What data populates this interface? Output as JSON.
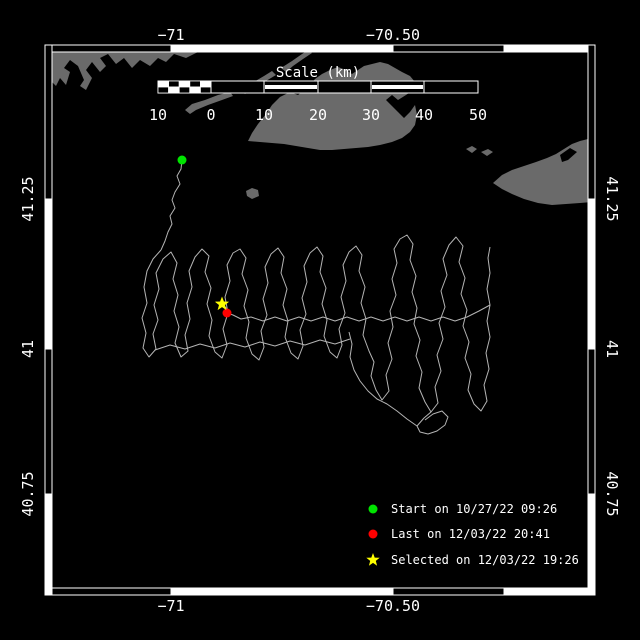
{
  "title": "Glider track map",
  "colors": {
    "background": "#000000",
    "land": "#6a6a6a",
    "track": "#b4b4b4",
    "frame_white": "#ffffff",
    "frame_black": "#000000",
    "text": "#ffffff",
    "start_marker": "#00e400",
    "last_marker": "#ff0000",
    "selected_marker": "#ffff00"
  },
  "frame": {
    "outer": {
      "x": 45,
      "y": 45,
      "w": 550,
      "h": 550
    },
    "band": 7,
    "horizontal_segments": [
      {
        "from": 45,
        "to": 171,
        "fill": "black"
      },
      {
        "from": 171,
        "to": 393,
        "fill": "white"
      },
      {
        "from": 393,
        "to": 504,
        "fill": "black"
      },
      {
        "from": 504,
        "to": 595,
        "fill": "white"
      }
    ],
    "vertical_segments": [
      {
        "from": 45,
        "to": 199,
        "fill": "black"
      },
      {
        "from": 199,
        "to": 349,
        "fill": "white"
      },
      {
        "from": 349,
        "to": 494,
        "fill": "black"
      },
      {
        "from": 494,
        "to": 595,
        "fill": "white"
      }
    ]
  },
  "axis": {
    "top": {
      "baseline_y": 40,
      "ticks": [
        {
          "text": "−71",
          "x": 171
        },
        {
          "text": "−70.50",
          "x": 393
        }
      ]
    },
    "bottom": {
      "baseline_y": 611,
      "ticks": [
        {
          "text": "−71",
          "x": 171
        },
        {
          "text": "−70.50",
          "x": 393
        }
      ]
    },
    "left": {
      "line_x": 33,
      "ticks": [
        {
          "text": "41.25",
          "y": 199
        },
        {
          "text": "41",
          "y": 349
        },
        {
          "text": "40.75",
          "y": 494
        }
      ]
    },
    "right": {
      "line_x": 607,
      "ticks": [
        {
          "text": "41.25",
          "y": 199
        },
        {
          "text": "41",
          "y": 349
        },
        {
          "text": "40.75",
          "y": 494
        }
      ]
    }
  },
  "scalebar": {
    "title": "Scale (km)",
    "title_x": 318,
    "title_y": 77,
    "x": 158,
    "y": 81,
    "width": 320,
    "height": 12,
    "checker": {
      "from": 158,
      "to": 211,
      "cells": 5
    },
    "segments": [
      {
        "from": 211,
        "to": 264,
        "stripe": false
      },
      {
        "from": 264,
        "to": 318,
        "stripe": true
      },
      {
        "from": 318,
        "to": 371,
        "stripe": false
      },
      {
        "from": 371,
        "to": 424,
        "stripe": true
      },
      {
        "from": 424,
        "to": 478,
        "stripe": false
      }
    ],
    "labels": [
      {
        "text": "10",
        "x": 158
      },
      {
        "text": "0",
        "x": 211
      },
      {
        "text": "10",
        "x": 264
      },
      {
        "text": "20",
        "x": 318
      },
      {
        "text": "30",
        "x": 371
      },
      {
        "text": "40",
        "x": 424
      },
      {
        "text": "50",
        "x": 478
      }
    ],
    "label_baseline_y": 120
  },
  "markers": {
    "start": {
      "x": 182,
      "y": 160,
      "r": 4.5
    },
    "last": {
      "x": 227,
      "y": 313,
      "r": 4.5
    },
    "selected": {
      "x": 222,
      "y": 304,
      "r": 7.5
    }
  },
  "legend": {
    "marker_x": 373,
    "text_x": 391,
    "rows_y": [
      509,
      534,
      560
    ],
    "items": [
      {
        "marker": "circle",
        "color_key": "start_marker",
        "label": "Start on 10/27/22 09:26"
      },
      {
        "marker": "circle",
        "color_key": "last_marker",
        "label": "Last on 12/03/22 20:41"
      },
      {
        "marker": "star",
        "color_key": "selected_marker",
        "label": "Selected on 12/03/22 19:26"
      }
    ]
  },
  "land": {
    "polygons": [
      {
        "name": "mainland-coast",
        "fill": "land",
        "points": "47,49 205,49 196,53 186,58 174,54 166,62 158,58 150,66 140,60 132,68 124,58 116,64 108,54 100,58 106,66 100,72 92,62 86,70 92,78 86,90 80,86 84,80 78,66 70,60 64,68 70,72 66,85 60,78 56,86 52,82 47,88"
      },
      {
        "name": "elizabeth-island-a",
        "fill": "land",
        "points": "185,110 192,104 205,100 218,95 230,92 233,96 222,100 208,105 196,110 190,114"
      },
      {
        "name": "elizabeth-island-b",
        "fill": "land",
        "points": "240,90 252,83 264,76 272,71 276,75 266,81 254,88 245,94"
      },
      {
        "name": "elizabeth-island-c",
        "fill": "land",
        "points": "281,68 292,61 302,54 308,50 312,53 303,59 293,66 286,72"
      },
      {
        "name": "marthas-vineyard",
        "fill": "land",
        "points": "248,141 252,133 258,124 266,114 272,105 280,97 290,92 298,95 304,90 310,85 315,79 322,74 330,70 338,67 346,70 352,74 358,70 364,66 372,64 380,62 388,64 395,68 402,72 410,76 415,82 413,90 406,95 398,100 392,95 386,100 392,106 398,112 404,118 410,112 415,105 417,115 415,125 410,132 402,138 392,142 380,145 368,147 356,148 344,149 332,150 320,150 308,148 296,146 284,144 272,143 260,142"
      },
      {
        "name": "no-mans-land",
        "fill": "land",
        "points": "246,191 252,188 258,190 259,196 252,199 247,196"
      },
      {
        "name": "muskeget",
        "fill": "land",
        "points": "466,149 472,146 477,149 472,153"
      },
      {
        "name": "tuckernuck",
        "fill": "land",
        "points": "481,152 488,149 493,152 487,156"
      },
      {
        "name": "nantucket",
        "fill": "land",
        "points": "493,183 502,175 512,170 524,166 536,162 547,158 556,154 564,149 572,144 580,141 588,139 592,139 592,202 580,203 566,204 552,205 538,203 524,199 512,194 502,189"
      },
      {
        "name": "nantucket-harbor",
        "fill": "background",
        "points": "560,155 570,148 577,152 568,160 562,162"
      }
    ]
  },
  "track": {
    "polylines": [
      "182,160 181,169 177,176 180,184 175,192 172,200 175,208 170,216 172,224 168,232 165,241 161,250",
      "161,250 153,259 147,271 144,287 147,303 142,318 146,333 143,348 149,357 156,349 153,334 158,320 154,305 159,289 156,273 163,259 171,252 177,263 173,279 178,295 174,311 179,327 175,343 181,357 188,351 185,335 190,319 187,303 192,287 189,271 195,257 202,249 209,256 205,272 211,288 207,304 212,320 209,336 215,352 222,358 227,345 223,329 228,313 225,297 230,281 227,265 233,253 240,249 246,258 242,274 248,290 244,306 249,322 246,338 252,354 259,360 264,347 261,331 267,315 263,299 268,283 265,267 271,254 278,248 284,257 281,273 287,289 283,305 288,321 285,337 291,353 298,359 303,346 300,330 306,314 302,298 307,282 304,266 310,253 317,247 323,256 320,272 326,288 322,304 327,320 324,336 330,352 337,358 342,345 339,329 345,313 341,297 346,281 343,265 349,252 356,246 362,255 359,271 365,287 361,303 366,319 363,335 369,351 374,362 371,376 376,390 382,400 389,391 386,375 392,359 388,343 393,327 390,311 396,295 392,279 397,263 394,249 400,239 407,235 413,244 410,260 416,276 412,292 417,308 414,324 420,340 416,356 422,372 419,388 425,402 431,412 438,403 435,387 441,371 437,355 443,339 439,323 445,307 441,291 447,275 443,259 449,245 456,237 463,246 459,262 465,278 461,294 467,310 463,326 469,342 465,358 471,374 468,390 474,404 481,411 487,401 484,385 489,369 486,353 490,337 487,321 490,305 487,289 490,273 488,258 490,247",
      "431,412 424,418 417,426 420,432 428,434 437,431 445,425 448,417 442,411 433,414 425,420",
      "417,426 407,419 397,411 387,404 377,399 368,391 360,381 354,370 350,357 352,344 349,332",
      "490,305 479,311 467,317 455,321 443,317 431,321 419,317 407,321 395,317 383,321 371,317 359,321 347,317 335,321 323,317 311,321 299,317 287,321 275,317 263,321 251,317 241,319 233,315 227,313",
      "155,350 170,345 185,349 200,344 215,348 230,343 245,347 260,342 275,346 290,341 305,345 320,340 335,344 350,339",
      "216,302 222,304 226,308 227,313"
    ]
  }
}
